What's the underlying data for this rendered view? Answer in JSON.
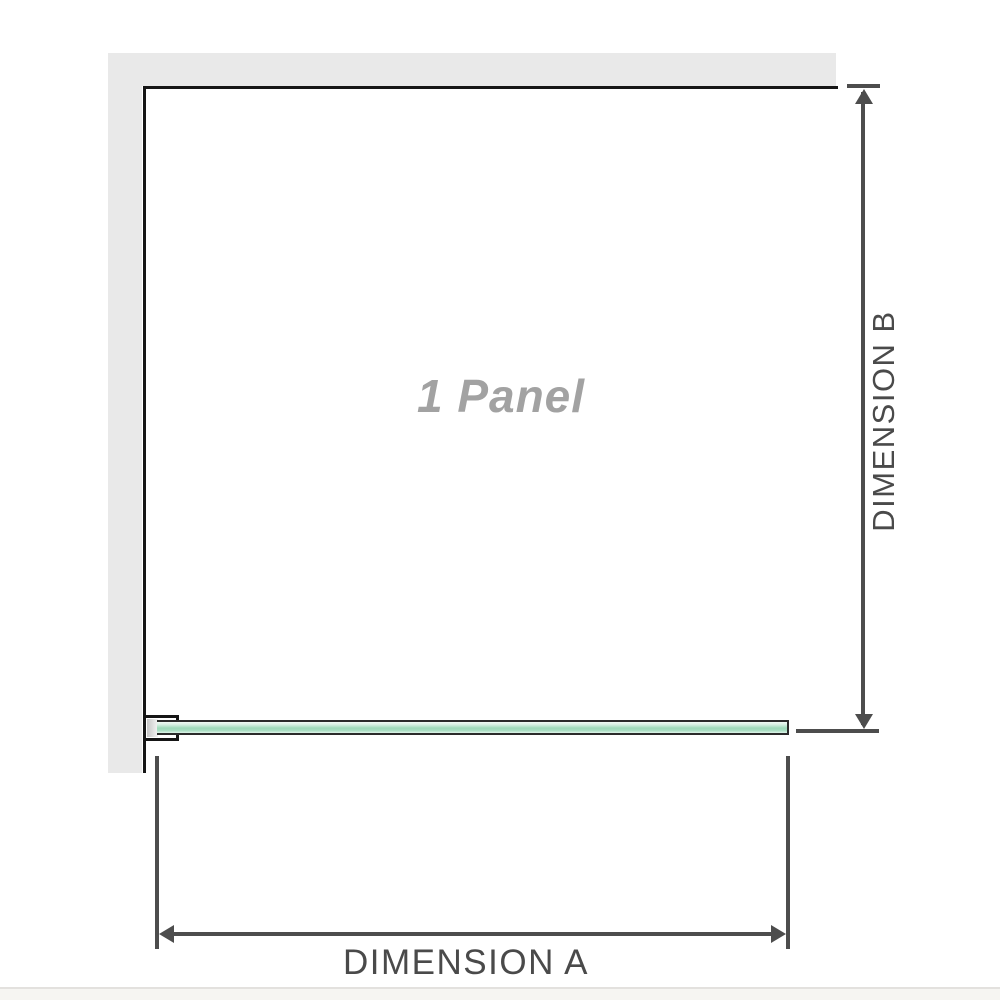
{
  "diagram": {
    "panel_label": "1 Panel",
    "dimensions": {
      "a": {
        "label": "DIMENSION A"
      },
      "b": {
        "label": "DIMENSION B"
      }
    },
    "colors": {
      "wall": "#e9e9e9",
      "panel_border": "#161616",
      "glass_green": "#9ed9ba",
      "glass_green_light": "#d5efe1",
      "bracket_border": "#151515",
      "dimension_line": "#4d4d4d",
      "dimension_text": "#4a4a4a",
      "panel_label_text": "#a2a2a2",
      "footer_divider": "#e3e1de",
      "footer_bg": "#f6f5f2"
    }
  }
}
